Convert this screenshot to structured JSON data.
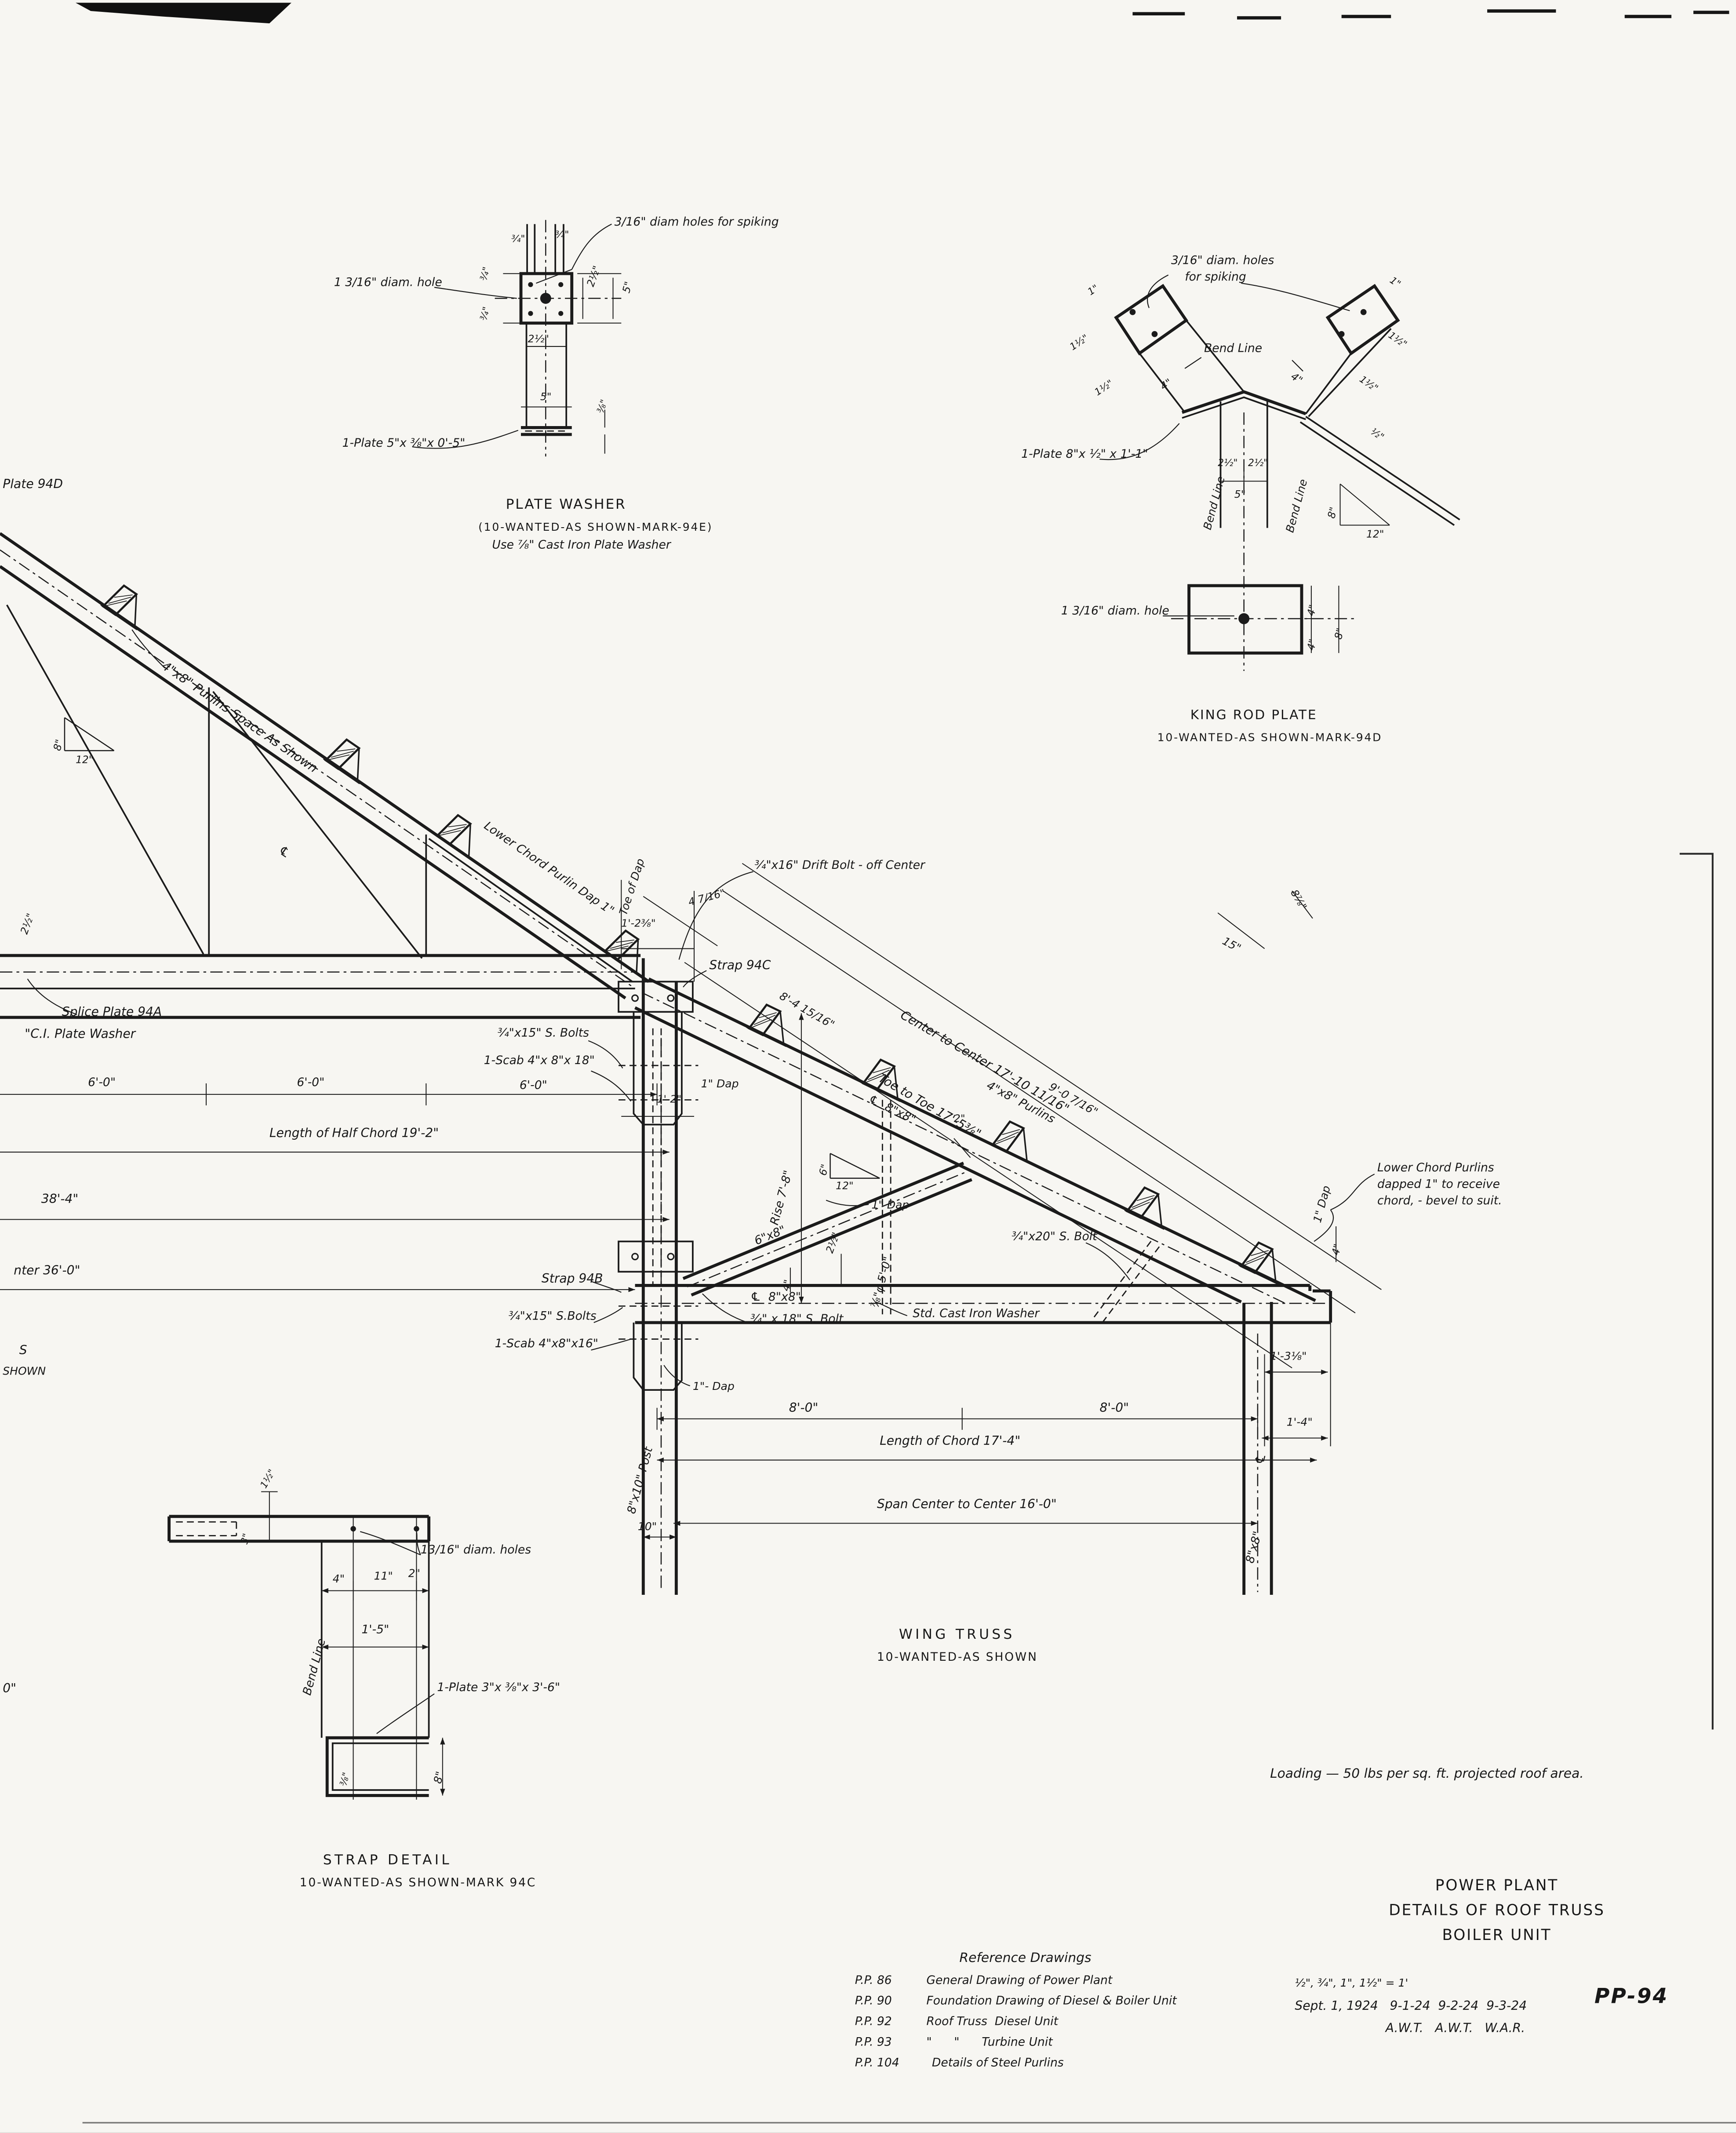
{
  "sheet": {
    "number": "PP-94",
    "loading_note": "Loading — 50 lbs per sq. ft. projected roof area."
  },
  "title_block": {
    "line1": "POWER PLANT",
    "line2": "DETAILS OF ROOF TRUSS",
    "line3": "BOILER UNIT",
    "scale_note": "½\", ¾\", 1\", 1½\" = 1'",
    "date_line": "Sept. 1, 1924   9-1-24  9-2-24  9-3-24",
    "initials_line": "A.W.T.   A.W.T.   W.A.R.",
    "number": "PP-94"
  },
  "reference_drawings": {
    "title": "Reference Drawings",
    "items": [
      {
        "no": "P.P. 86",
        "desc": "General Drawing of Power Plant"
      },
      {
        "no": "P.P. 90",
        "desc": "Foundation Drawing of Diesel & Boiler Unit"
      },
      {
        "no": "P.P. 92",
        "desc": "Roof Truss  Diesel Unit"
      },
      {
        "no": "P.P. 93",
        "desc": "\"      \"      Turbine Unit"
      },
      {
        "no": "P.P. 104",
        "desc": "Details of Steel Purlins"
      }
    ]
  },
  "plate_washer": {
    "spiking_note": "3/16\" diam holes for spiking",
    "hole_note": "1 3/16\" diam. hole",
    "plate_note": "1-Plate 5\"x ⅜\"x 0'-5\"",
    "dim_34_a": "¾\"",
    "dim_34_b": "¾\"",
    "dim_34_c": "¾\"",
    "dim_34_d": "¾\"",
    "dim_2half_side": "2½\"",
    "dim_5_side": "5\"",
    "dim_2half_bot": "2½\"",
    "dim_5_bot": "5\"",
    "dim_38": "⅜\"",
    "title": "PLATE WASHER",
    "subtitle": "(10-WANTED-AS SHOWN-MARK-94E)",
    "note": "Use ⅞\" Cast Iron Plate Washer"
  },
  "king_rod_plate": {
    "spiking_note_1": "3/16\" diam. holes",
    "spiking_note_2": "for spiking",
    "bend_line_top": "Bend Line",
    "bend_line_left": "Bend Line",
    "bend_line_right": "Bend Line",
    "plate_note": "1-Plate 8\"x ½\" x 1'-1\"",
    "hole_note": "1 3/16\" diam. hole",
    "dim_1_left": "1\"",
    "dim_1_right": "1\"",
    "dim_1half_lu": "1½\"",
    "dim_1half_ll": "1½\"",
    "dim_1half_ru": "1½\"",
    "dim_1half_rl": "1½\"",
    "dim_4_left": "4\"",
    "dim_4_right": "4\"",
    "dim_half_edge": "½\"",
    "dim_2half_a": "2½\"",
    "dim_2half_b": "2½\"",
    "dim_5": "5\"",
    "tri_rise": "8\"",
    "tri_run": "12\"",
    "dim_4_top": "4\"",
    "dim_4_bot": "4\"",
    "dim_8": "8\"",
    "title": "KING ROD PLATE",
    "subtitle": "10-WANTED-AS SHOWN-MARK-94D"
  },
  "truss": {
    "edge_plate_ref": "Plate 94D",
    "tri_left_rise": "8\"",
    "tri_left_run": "12\"",
    "purlins_spacing_note": "4\"x8\" Purlins Space As Shown",
    "cl_chord": "℄",
    "dim_2half_left": "2½\"",
    "splice_plate": "Splice Plate 94A",
    "ci_plate_washer": "\"C.I. Plate Washer",
    "dim_6ft_a": "6'-0\"",
    "dim_6ft_b": "6'-0\"",
    "dim_6ft_c": "6'-0\"",
    "half_chord_note": "Length of Half Chord 19'-2\"",
    "dim_38_4": "38'-4\"",
    "dim_center_36": "nter 36'-0\"",
    "margin_s": "S",
    "margin_shown": "SHOWN",
    "margin_zero": "0\"",
    "purlin_dap_note": "Lower Chord Purlin Dap 1\"",
    "toe_of_dap": "Toe of Dap",
    "dim_1_2_38": "1'-2⅜\"",
    "dim_4_716": "4 7/16\"",
    "drift_bolt_note": "¾\"x16\" Drift Bolt - off Center",
    "center_to_center": "Center to Center 17'-10 11/16\"",
    "toe_to_toe": "Toe to Toe 17'-5⅜\"",
    "strap_94c": "Strap 94C",
    "dim_8_4_1516": "8'-4 15/16\"",
    "dim_9_0_716": "9'-0 7/16\"",
    "upper_bolts": "¾\"x15\" S. Bolts",
    "upper_scab": "1-Scab 4\"x 8\"x 18\"",
    "dap_upper": "1\" Dap",
    "dim_1_2": "1'-2\"",
    "rise_note": "Rise 7'-8\"",
    "tri_mid_rise": "6\"",
    "tri_mid_run": "12\"",
    "strut_size": "6\"x8\"",
    "dim_2half_dap": "2½\"",
    "dap_mid": "1\" Dap",
    "dim_2": "2\"",
    "purlins_4x8": "4\"x8\" Purlins",
    "top_chord_cl": "℄  8\"x8\"",
    "king_rod": "⅞\"φ 5'-0\"",
    "dim_15": "15\"",
    "dim_8_78": "8⅞\"",
    "bolt_20": "¾\"x20\" S. Bolt",
    "dap_right": "1\" Dap",
    "purlins_dapped_1": "Lower Chord Purlins",
    "purlins_dapped_2": "dapped 1\" to receive",
    "purlins_dapped_3": "chord, - bevel to suit.",
    "bottom_chord_cl": "℄  8\"x8\"",
    "washer_note": "Std. Cast Iron Washer",
    "strap_94b": "Strap 94B",
    "lower_bolts": "¾\"x15\" S.Bolts",
    "lower_scab": "1-Scab 4\"x8\"x16\"",
    "bolt_18": "¾\" x 18\" S. Bolt",
    "dap_lower": "1\"- Dap",
    "dim_8ft_a": "8'-0\"",
    "dim_8ft_b": "8'-0\"",
    "chord_length": "Length of Chord 17'-4\"",
    "span_note": "Span Center to Center 16'-0\"",
    "post_label": "8\"x10\" Post",
    "dim_10": "10\"",
    "dim_4_a": "4\"",
    "dim_4_b": "4\"",
    "dim_1_3_18": "1'-3⅛\"",
    "dim_1_4": "1'-4\"",
    "right_post_label": "8\"x8\"",
    "cl_post": "℄",
    "title": "WING TRUSS",
    "subtitle": "10-WANTED-AS SHOWN"
  },
  "strap_detail": {
    "dim_1half": "1½\"",
    "dim_3": "3\"",
    "holes_note": "13/16\" diam. holes",
    "dim_4": "4\"",
    "dim_11": "11\"",
    "dim_2": "2\"",
    "bend_line": "Bend Line",
    "dim_1_5": "1'-5\"",
    "plate_note": "1-Plate 3\"x ⅜\"x 3'-6\"",
    "dim_38": "⅜\"",
    "dim_8": "8\"",
    "title": "STRAP DETAIL",
    "subtitle": "10-WANTED-AS SHOWN-MARK 94C"
  }
}
